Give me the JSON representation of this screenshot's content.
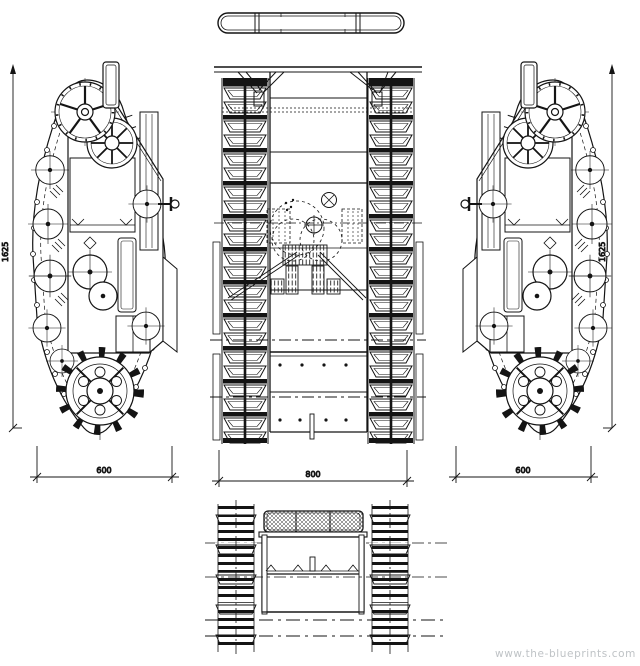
{
  "drawing": {
    "watermark": "www.the-blueprints.com",
    "dimensions": {
      "side_left_height": "1625",
      "side_left_width": "600",
      "plan_width": "800",
      "side_right_height": "1625",
      "side_right_width": "600"
    },
    "colors": {
      "ink": "#141414",
      "background": "#ffffff",
      "watermark": "#bfc3c6"
    }
  }
}
